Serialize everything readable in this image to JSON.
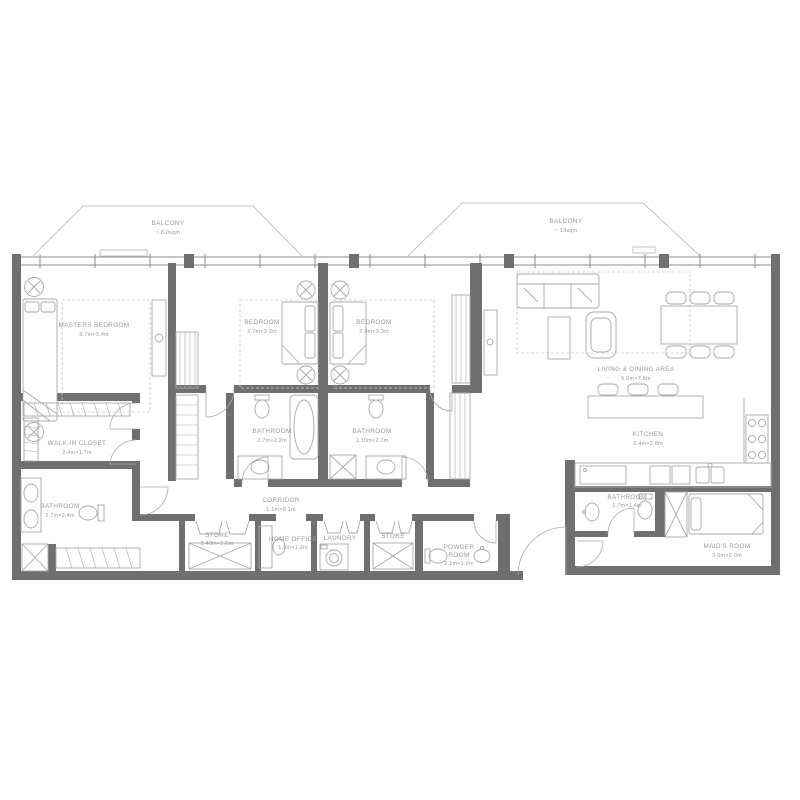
{
  "colors": {
    "wall": "#6f6f6f",
    "line": "#a9a9a9",
    "text": "#9a9a9a",
    "background": "#ffffff"
  },
  "balconies": [
    {
      "name": "BALCONY",
      "area": "~ 8.0sqm"
    },
    {
      "name": "BALCONY",
      "area": "~ 13sqm"
    }
  ],
  "rooms": [
    {
      "id": "masters-bedroom",
      "name": "MASTERS BEDROOM",
      "dims": "3.7m×3.4m"
    },
    {
      "id": "bedroom-2",
      "name": "BEDROOM",
      "dims": "3.7m×3.2m"
    },
    {
      "id": "bedroom-3",
      "name": "BEDROOM",
      "dims": "3.9m×3.3m"
    },
    {
      "id": "living-dining",
      "name": "LIVING & DINING AREA",
      "dims": "5.0m×7.8m"
    },
    {
      "id": "kitchen",
      "name": "KITCHEN",
      "dims": "2.4m×2.8m"
    },
    {
      "id": "walk-in-closet",
      "name": "WALK-IN CLOSET",
      "dims": "2.4m×1.7m"
    },
    {
      "id": "master-bathroom",
      "name": "BATHROOM",
      "dims": "2.7m×2.4m"
    },
    {
      "id": "bathroom-2",
      "name": "BATHROOM",
      "dims": "2.7m×2.2m"
    },
    {
      "id": "bathroom-3",
      "name": "BATHROOM",
      "dims": "1.10m×2.2m"
    },
    {
      "id": "corridor",
      "name": "CORRIDOR",
      "dims": "1.1m×8.1m"
    },
    {
      "id": "store-1",
      "name": "STORE",
      "dims": "2.40m×1.6m"
    },
    {
      "id": "home-office",
      "name": "HOME OFFICE",
      "dims": "1.5m×1.2m"
    },
    {
      "id": "laundry",
      "name": "LAUNDRY",
      "dims": ""
    },
    {
      "id": "store-2",
      "name": "STORE",
      "dims": ""
    },
    {
      "id": "powder-room",
      "line1": "POWDER",
      "line2": "ROOM",
      "dims": "2.1m×1.2m"
    },
    {
      "id": "maid-bathroom",
      "name": "BATHROOM",
      "dims": "1.7m×1.4m"
    },
    {
      "id": "maids-room",
      "name": "MAID'S ROOM",
      "dims": "3.0m×2.0m"
    }
  ]
}
